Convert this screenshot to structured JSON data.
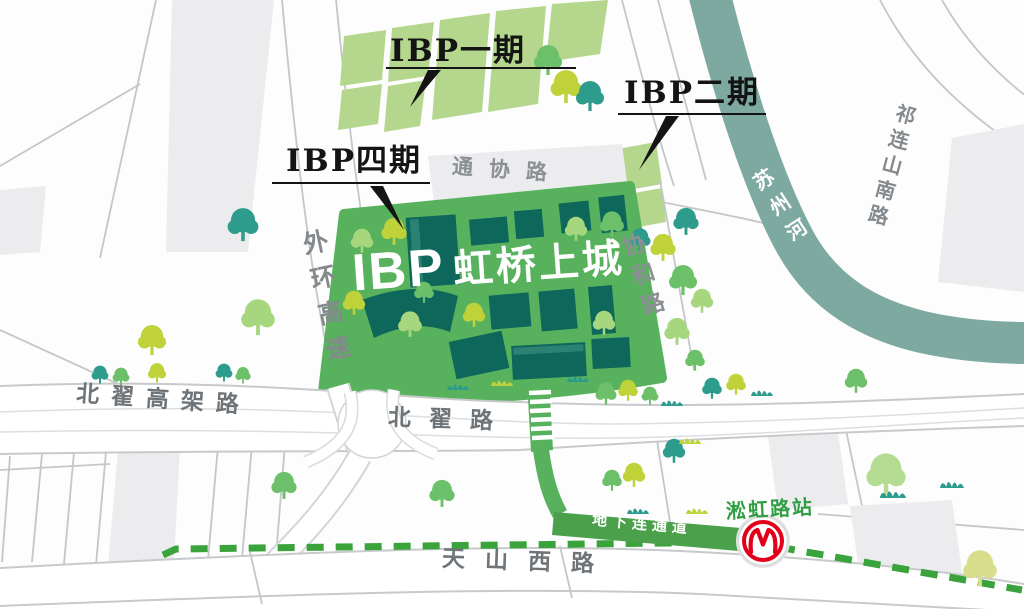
{
  "map": {
    "project_title": {
      "latin": "IBP",
      "cn": "虹桥上城"
    },
    "callouts": {
      "phase1": "IBP一期",
      "phase2": "IBP二期",
      "phase4": "IBP四期"
    },
    "roads": {
      "tongxie_road": "通协路",
      "xiehe_road": "协和路",
      "waihuan_expressway": "外环高速",
      "beizhai_elevated_road": "北翟高架路",
      "beizhai_road": "北翟路",
      "tianshan_west_road": "天山西路",
      "qilianshan_south_road": "祁连山南路"
    },
    "river": {
      "name": "苏州河"
    },
    "transit": {
      "station_name": "淞虹路站",
      "underground_passage": "地下连通道",
      "metro_logo": "shanghai-metro-logo",
      "line_style": "green-dashed"
    },
    "colors": {
      "campus_green": "#58b25d",
      "parcel_green": "#b4d78d",
      "building_teal": "#0e675b",
      "river_teal": "#7ea9a0",
      "metro_line_green": "#3aa33c",
      "station_green": "#2f9e44",
      "passage_green": "#4aa04b",
      "metro_red": "#e2001a",
      "road_edge": "#c7cacb",
      "parcel_gray": "#ececee",
      "label_gray": "#84898d",
      "road_label_dark": "#6f7478",
      "callout_ink": "#141414"
    }
  }
}
